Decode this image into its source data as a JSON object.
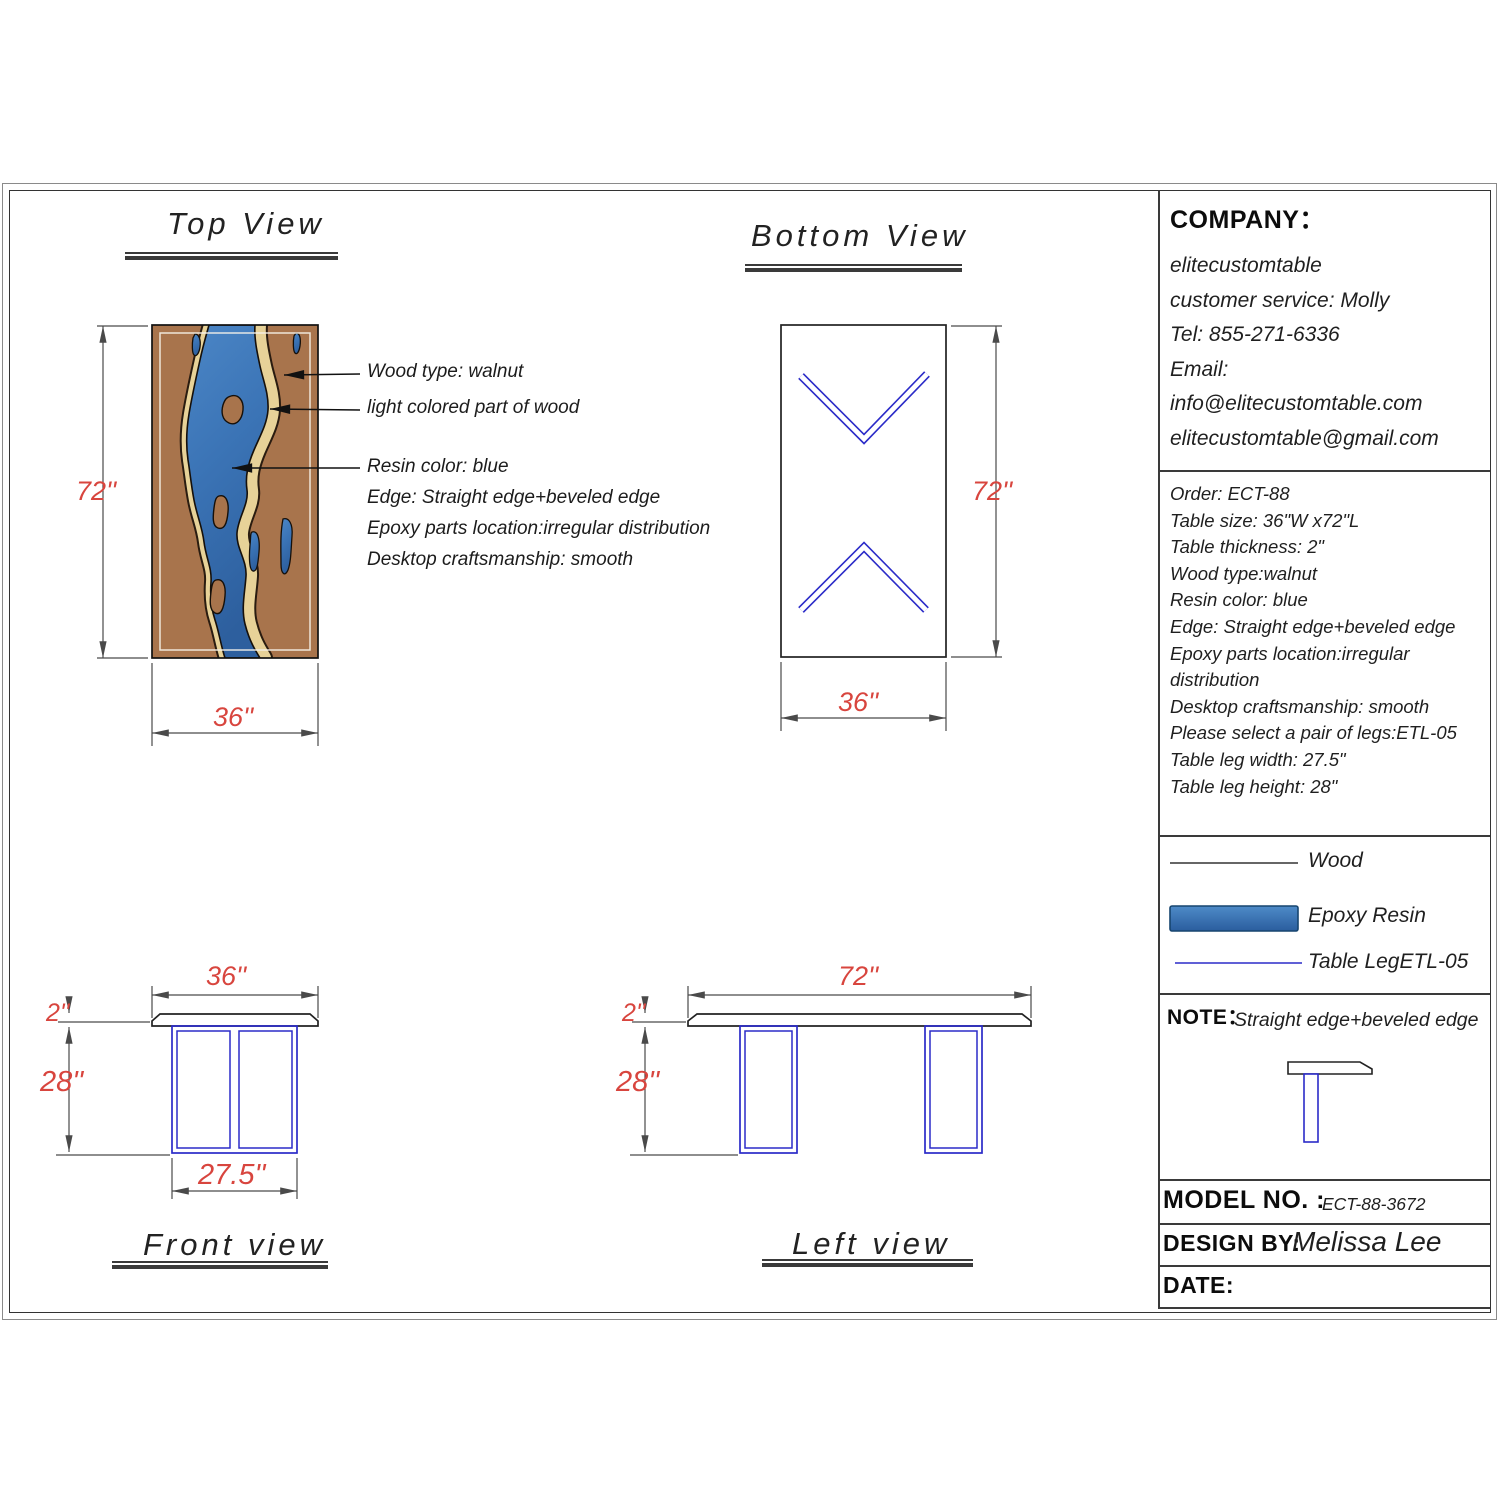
{
  "titles": {
    "top_view": "Top View",
    "bottom_view": "Bottom View",
    "front_view": "Front view",
    "left_view": "Left view"
  },
  "annotations": {
    "wood_type": "Wood type: walnut",
    "light_wood": "light colored part of wood",
    "resin_color": "Resin color: blue",
    "edge": "Edge: Straight edge+beveled edge",
    "epoxy_location": "Epoxy parts location:irregular distribution",
    "craftsmanship": "Desktop craftsmanship: smooth"
  },
  "dimensions": {
    "top_view_height": "72''",
    "top_view_width": "36''",
    "bottom_view_height": "72''",
    "bottom_view_width": "36''",
    "front_width": "36''",
    "front_thickness": "2''",
    "front_leg_height": "28''",
    "front_leg_width": "27.5''",
    "left_width": "72''",
    "left_thickness": "2''",
    "left_leg_height": "28''"
  },
  "company": {
    "heading": "COMPANY：",
    "lines": [
      "elitecustomtable",
      "customer service: Molly",
      "Tel: 855-271-6336",
      "Email:",
      "info@elitecustomtable.com",
      "elitecustomtable@gmail.com"
    ]
  },
  "order": {
    "lines": [
      "Order: ECT-88",
      "Table size: 36\"W x72\"L",
      "Table thickness: 2\"",
      "Wood type:walnut",
      "Resin color: blue",
      "Edge: Straight edge+beveled edge",
      "Epoxy parts location:irregular",
      "distribution",
      "Desktop craftsmanship: smooth",
      "Please select a pair of legs:ETL-05",
      "Table leg width: 27.5\"",
      "Table leg height: 28\""
    ]
  },
  "legend": {
    "wood": "Wood",
    "epoxy": "Epoxy Resin",
    "table_leg": "Table LegETL-05"
  },
  "note": {
    "heading": "NOTE：",
    "text": "Straight edge+beveled edge"
  },
  "title_block": {
    "model_label": "MODEL NO. :",
    "model_value": "ECT-88-3672",
    "design_label": "DESIGN BY:",
    "design_value": "Melissa Lee",
    "date_label": "DATE:"
  },
  "colors": {
    "wood": "#a8744c",
    "light_wood": "#e7d298",
    "resin_dark": "#2d5f9e",
    "resin_light": "#4b86c6",
    "leg_blue": "#2b2bc8",
    "dimension_red": "#d8453e",
    "line_gray": "#555555"
  }
}
